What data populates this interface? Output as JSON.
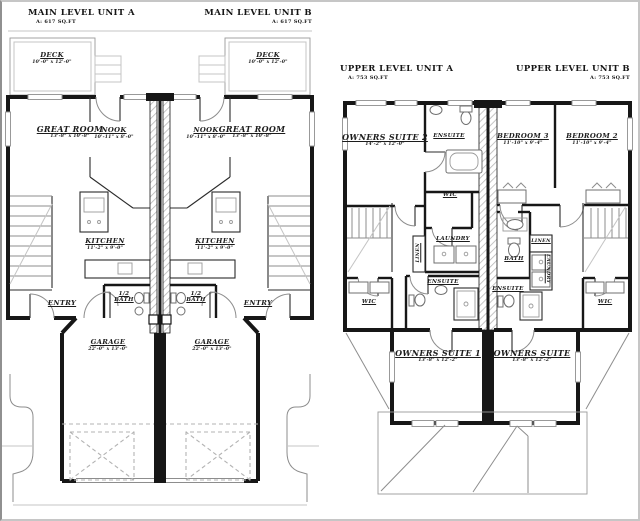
{
  "image": {
    "kind": "duplex floor plan drawing",
    "background": "#ffffff",
    "wall_color": "#171717",
    "thin_line_color": "#8d8d8d",
    "dashed_line_color": "#b3b3b3",
    "frame_color": "#c6c6c6"
  },
  "titles": {
    "main_a": {
      "title": "MAIN LEVEL UNIT A",
      "area": "A: 617 SQ.FT"
    },
    "main_b": {
      "title": "MAIN LEVEL UNIT B",
      "area": "A: 617 SQ.FT"
    },
    "upper_a": {
      "title": "UPPER LEVEL UNIT A",
      "area": "A: 753 SQ.FT"
    },
    "upper_b": {
      "title": "UPPER LEVEL UNIT B",
      "area": "A: 753 SQ.FT"
    }
  },
  "main_level": {
    "deck_a": {
      "name": "DECK",
      "dim": "10'-0\" x 12'-0\""
    },
    "deck_b": {
      "name": "DECK",
      "dim": "10'-0\" x 12'-0\""
    },
    "great_room_a": {
      "name": "GREAT ROOM",
      "dim": "13'-8\" x 10'-8\""
    },
    "nook_a": {
      "name": "NOOK",
      "dim": "10'-11\" x 8'-0\""
    },
    "nook_b": {
      "name": "NOOK",
      "dim": "10'-11\" x 8'-0\""
    },
    "great_room_b": {
      "name": "GREAT ROOM",
      "dim": "13'-8\" x 10'-8\""
    },
    "kitchen_a": {
      "name": "KITCHEN",
      "dim": "11'-2\" x 9'-0\""
    },
    "kitchen_b": {
      "name": "KITCHEN",
      "dim": "11'-2\" x 9'-0\""
    },
    "entry_a": {
      "name": "ENTRY"
    },
    "entry_b": {
      "name": "ENTRY"
    },
    "half_bath_a": {
      "name": "1/2 BATH"
    },
    "half_bath_b": {
      "name": "1/2 BATH"
    },
    "garage_a": {
      "name": "GARAGE",
      "dim": "22'-0\" x 13'-0\""
    },
    "garage_b": {
      "name": "GARAGE",
      "dim": "22'-0\" x 13'-0\""
    }
  },
  "upper_level": {
    "owners_suite_2": {
      "name": "OWNERS SUITE 2",
      "dim": "14'-2\" x 12'-0\""
    },
    "ensuite_a_top": {
      "name": "ENSUITE"
    },
    "bedroom_3": {
      "name": "BEDROOM 3",
      "dim": "11'-10\" x 9'-4\""
    },
    "bedroom_2": {
      "name": "BEDROOM 2",
      "dim": "11'-10\" x 9'-4\""
    },
    "wic_a": {
      "name": "WIC"
    },
    "laundry_a": {
      "name": "LAUNDRY"
    },
    "linen_a": {
      "name": "LINEN"
    },
    "bath_b": {
      "name": "BATH"
    },
    "linen_b": {
      "name": "LINEN"
    },
    "laundry_b": {
      "name": "LAUNDRY"
    },
    "ensuite_a_lower": {
      "name": "ENSUITE"
    },
    "ensuite_b": {
      "name": "ENSUITE"
    },
    "wic_left": {
      "name": "WIC"
    },
    "wic_right": {
      "name": "WIC"
    },
    "owners_suite_1": {
      "name": "OWNERS SUITE 1",
      "dim": "13'-8\" x 12'-2\""
    },
    "owners_suite_b": {
      "name": "OWNERS SUITE",
      "dim": "13'-8\" x 12'-2\""
    }
  }
}
